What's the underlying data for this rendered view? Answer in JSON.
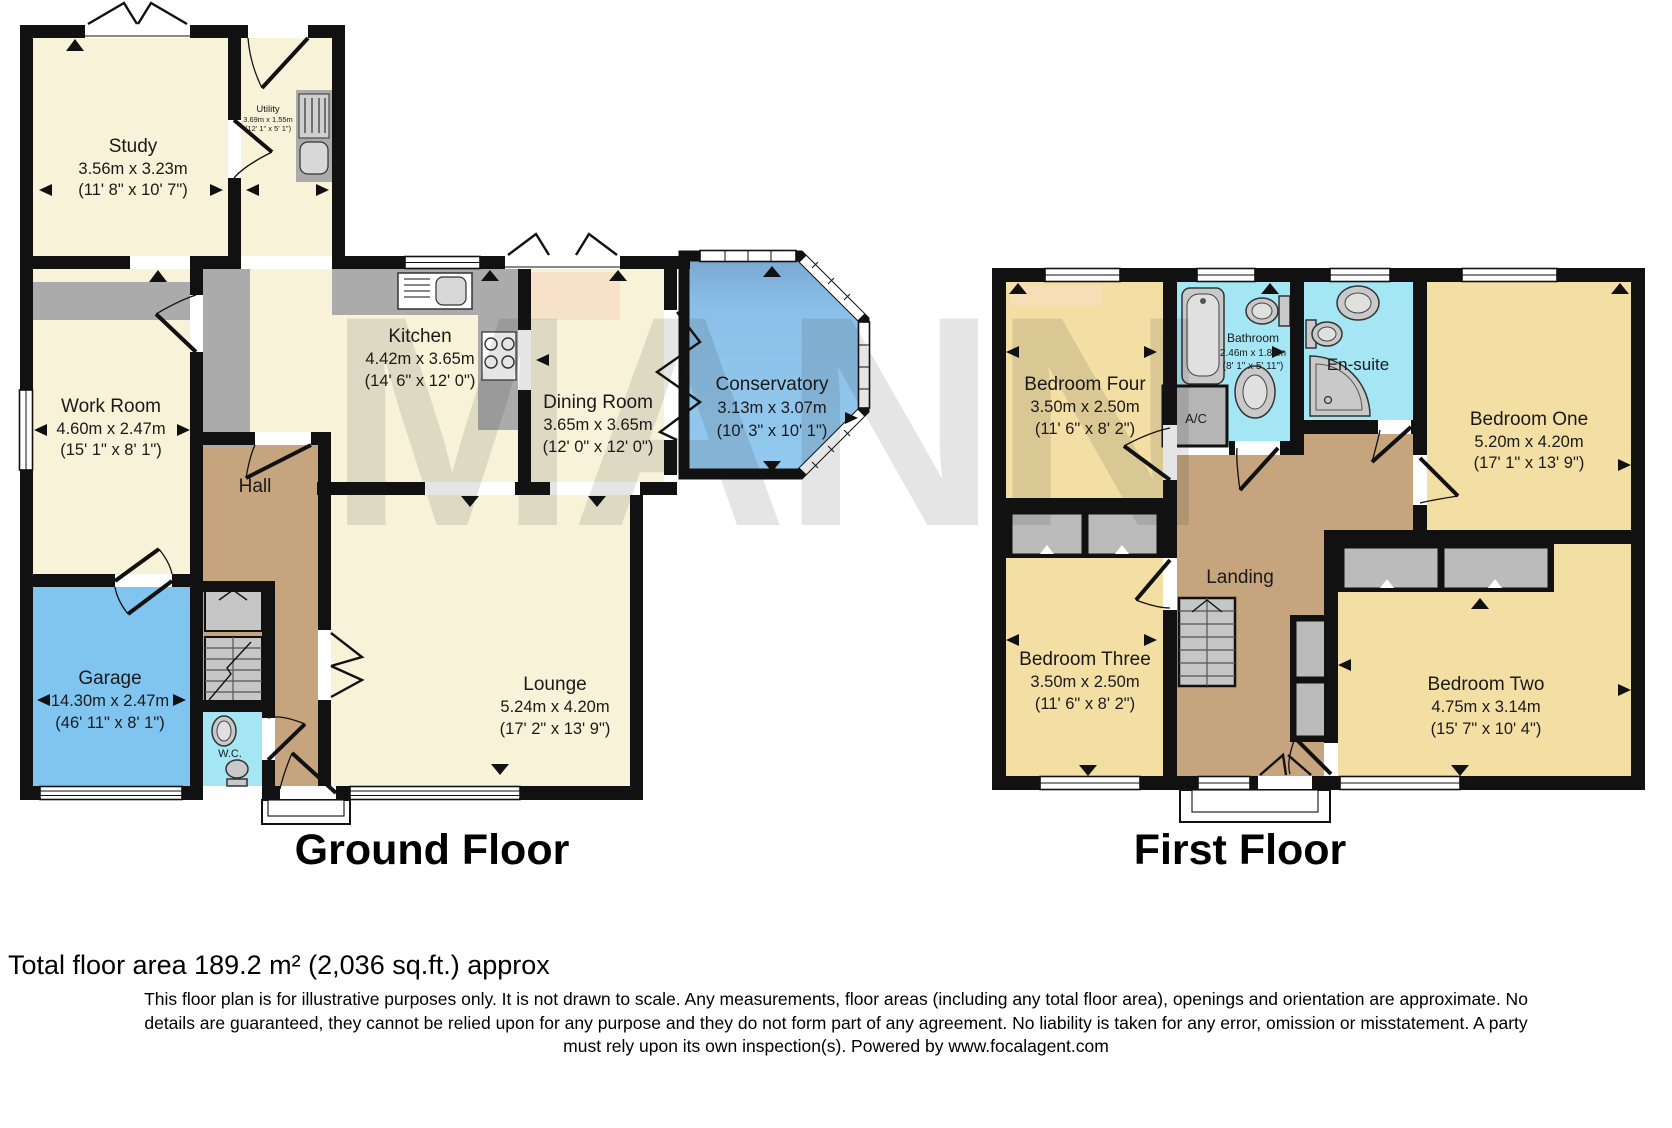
{
  "watermark": {
    "text": "MANN"
  },
  "titles": {
    "ground": "Ground Floor",
    "first": "First Floor"
  },
  "footer": {
    "total_area": "Total floor area 189.2 m² (2,036 sq.ft.) approx",
    "disclaimer_line1": "This floor plan is for illustrative purposes only. It is not drawn to scale. Any measurements, floor areas (including any total floor area), openings and orientation are approximate. No",
    "disclaimer_line2": "details are guaranteed, they cannot be relied upon for any purpose and they do not form part of any agreement. No liability is taken for any error, omission or misstatement. A party",
    "disclaimer_line3": "must rely upon its own inspection(s). Powered by www.focalagent.com"
  },
  "ground_floor": {
    "rooms": {
      "study": {
        "name": "Study",
        "metric": "3.56m x 3.23m",
        "imperial": "(11' 8\" x 10' 7\")"
      },
      "utility": {
        "name": "Utility",
        "metric": "3.69m x 1.55m",
        "imperial": "(12' 1\" x 5' 1\")"
      },
      "work_room": {
        "name": "Work Room",
        "metric": "4.60m x 2.47m",
        "imperial": "(15' 1\" x 8' 1\")"
      },
      "kitchen": {
        "name": "Kitchen",
        "metric": "4.42m x 3.65m",
        "imperial": "(14' 6\" x 12' 0\")"
      },
      "dining_room": {
        "name": "Dining Room",
        "metric": "3.65m x 3.65m",
        "imperial": "(12' 0\" x 12' 0\")"
      },
      "conservatory": {
        "name": "Conservatory",
        "metric": "3.13m x 3.07m",
        "imperial": "(10' 3\" x 10' 1\")"
      },
      "hall": {
        "name": "Hall"
      },
      "garage": {
        "name": "Garage",
        "metric": "14.30m x 2.47m",
        "imperial": "(46' 11\" x 8' 1\")"
      },
      "wc": {
        "name": "W.C."
      },
      "lounge": {
        "name": "Lounge",
        "metric": "5.24m x 4.20m",
        "imperial": "(17' 2\" x 13' 9\")"
      }
    }
  },
  "first_floor": {
    "rooms": {
      "bedroom_four": {
        "name": "Bedroom Four",
        "metric": "3.50m x 2.50m",
        "imperial": "(11' 6\" x 8' 2\")"
      },
      "bathroom": {
        "name": "Bathroom",
        "metric": "2.46m x 1.81m",
        "imperial": "(8' 1\" x 5' 11\")"
      },
      "ac": {
        "name": "A/C"
      },
      "en_suite": {
        "name": "En-suite"
      },
      "bedroom_one": {
        "name": "Bedroom One",
        "metric": "5.20m x 4.20m",
        "imperial": "(17' 1\" x 13' 9\")"
      },
      "landing": {
        "name": "Landing"
      },
      "bedroom_three": {
        "name": "Bedroom Three",
        "metric": "3.50m x 2.50m",
        "imperial": "(11' 6\" x 8' 2\")"
      },
      "bedroom_two": {
        "name": "Bedroom Two",
        "metric": "4.75m x 3.14m",
        "imperial": "(15' 7\" x 10' 4\")"
      }
    }
  },
  "colors": {
    "room_cream": "#f8f2d8",
    "bedroom_tan": "#f3dfa4",
    "hall_brown": "#c5a47e",
    "garage_blue": "#7fc5f0",
    "conservatory_blue": "#8cc3ea",
    "bath_cyan": "#a5e6f5",
    "wall_black": "#111111",
    "counter_gray": "#ababab"
  }
}
